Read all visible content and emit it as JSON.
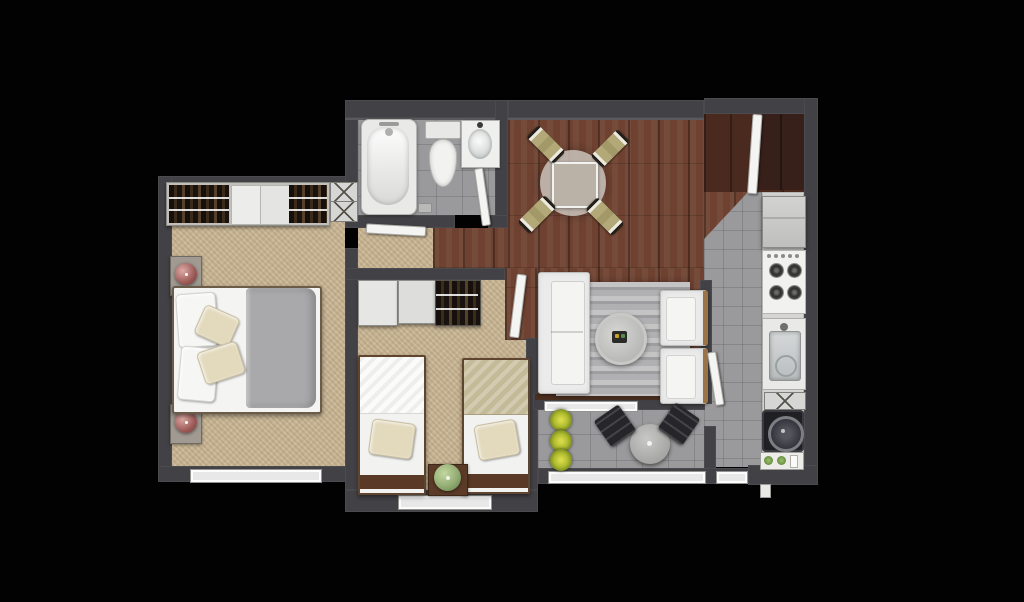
{
  "meta": {
    "title": "Apartment floor plan - top-down 3D render",
    "canvas_width": "1024",
    "canvas_height": "602"
  },
  "colors": {
    "wall": "#424246",
    "carpet": "#c7b493",
    "wood": "#6e4130",
    "woodDark": "#4a2a1f",
    "woodRecess": "#38201a",
    "tile": "#9a999b",
    "rug": "#b0b0b2",
    "sofa": "#ebebeb",
    "khaki": "#b3a878",
    "blanketGray": "#a9a9ab",
    "blanketOlive": "#c3ba97",
    "pillow": "#e3dabe",
    "lampPink": "#b97f7b",
    "lampGreen": "#93ac74",
    "plant": "#aebc2e",
    "counter": "#d6d5d3",
    "applianceWhite": "#f1f1ef",
    "washerBlack": "#202024",
    "frameBrown": "#5a3a26",
    "consoleBrown": "#4a2e1f",
    "door": "#f4f4f2",
    "window": "#e8e8e8",
    "tableGlass": "#c9c3bb"
  },
  "rooms": {
    "master_bedroom": "Master bedroom",
    "second_bedroom": "Second bedroom",
    "bathroom": "Bathroom",
    "hallway": "Hallway",
    "dining": "Dining area",
    "kitchen": "Kitchen",
    "living": "Living room",
    "terrace": "Terrace",
    "entry": "Entry"
  },
  "furniture": {
    "wardrobe": "Wardrobe with hanging clothes",
    "shoe_cabinet": "Shoe cabinet",
    "double_bed": "Double bed",
    "nightstand": "Nightstand",
    "table_lamp": "Table lamp",
    "window": "Window",
    "bathtub": "Bathtub",
    "toilet": "Toilet",
    "bathroom_sink": "Bathroom sink",
    "bathroom_door": "Bathroom door",
    "master_door": "Master bedroom door",
    "bedroom2_door": "Second bedroom door",
    "kitchen_door": "Kitchen door",
    "entrance_door": "Entrance door",
    "dining_table": "Round dining table",
    "dining_chair": "Dining chair",
    "refrigerator": "Refrigerator",
    "stove": "Gas stove",
    "kitchen_sink": "Kitchen sink",
    "kitchen_shelf": "Kitchen shelf",
    "washing_machine": "Washing machine",
    "plant_cabinet": "Cabinet with plants",
    "sofa": "Sofa",
    "rug": "Striped rug",
    "coffee_table": "Round coffee table",
    "armchair": "Armchair",
    "tv_console": "Console",
    "single_bed_left": "Single bed (white blanket)",
    "single_bed_right": "Single bed (olive blanket)",
    "bedside_table": "Bedside table",
    "terrace_table": "Terrace table",
    "terrace_chair": "Terrace chair",
    "terrace_plants": "Potted plants",
    "balcony_rail": "Balcony glazing"
  }
}
